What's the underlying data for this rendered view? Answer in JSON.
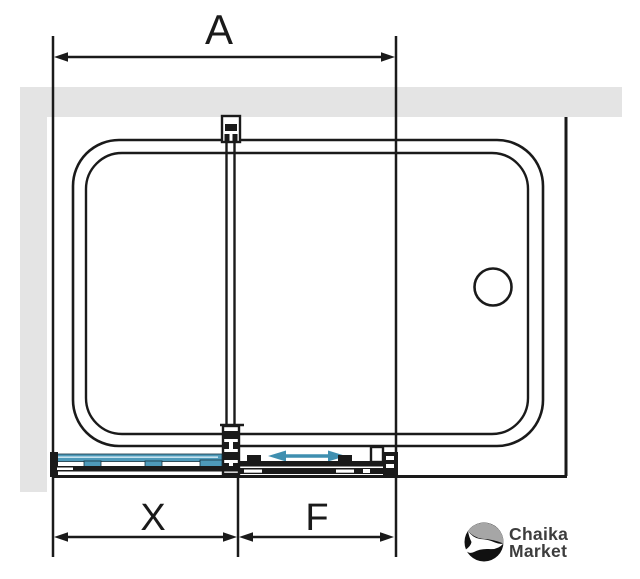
{
  "dimension_labels": {
    "total": "A",
    "sliding": "X",
    "fixed": "F"
  },
  "logo": {
    "line1": "Chaika",
    "line2": "Market",
    "icon": "seagull-circle-icon"
  },
  "colors": {
    "wall_gray": "#e4e4e4",
    "line_black": "#1a1a1a",
    "panel_blue": "#4e9aba",
    "panel_blue_light": "#c6e2ef",
    "arrow_blue": "#3f8fb0",
    "logo_gray": "#a6a6a6",
    "logo_black": "#111111",
    "logo_text_color": "#3d3d3d"
  }
}
